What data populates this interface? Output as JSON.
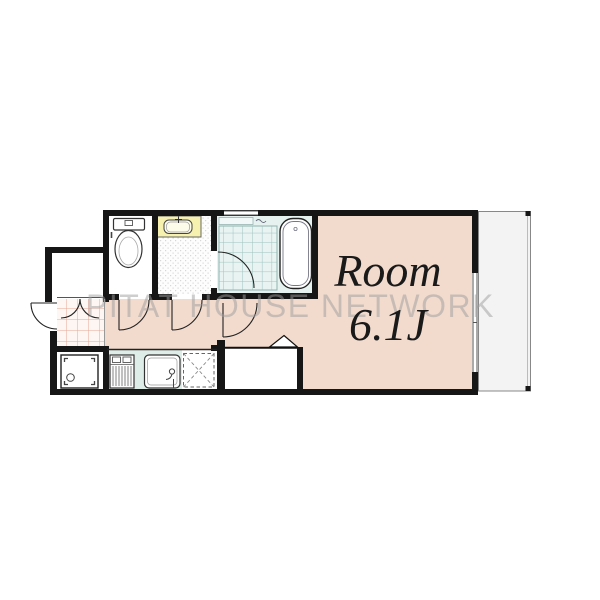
{
  "floorplan": {
    "room_label_line1": "Room",
    "room_label_line2": "6.1J",
    "watermark": "PITAT HOUSE NETWORK",
    "colors": {
      "room_floor": "#f2dbcd",
      "bathroom_floor": "#e6f2f0",
      "bath_tile_line": "#9dc3bf",
      "kitchen_floor": "#dfede8",
      "vanity_counter_yellow": "#f6f1ae",
      "entrance_tile_line": "#e5a898",
      "wall": "#161616",
      "balcony_floor": "#f3f3f3",
      "watermark_text": "#9e9e9e",
      "label_text": "#1a1a1a"
    }
  }
}
